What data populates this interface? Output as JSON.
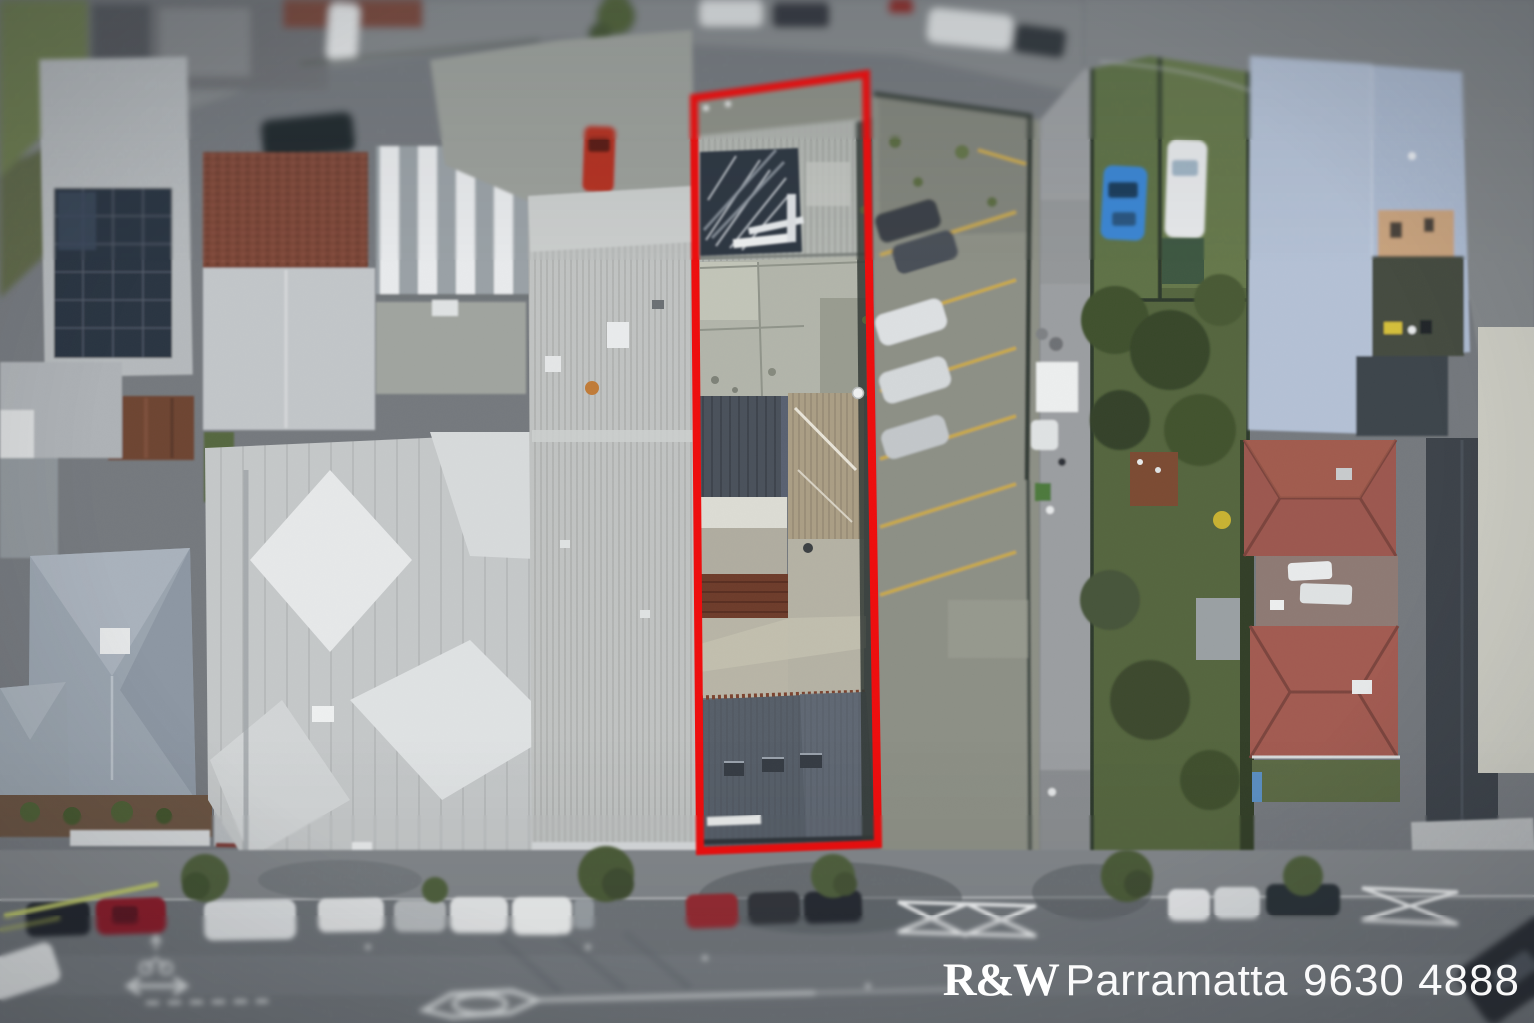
{
  "meta": {
    "canvas_width_px": 1534,
    "canvas_height_px": 1023
  },
  "watermark": {
    "brand": "R&W",
    "office": "Parramatta",
    "phone": "9630 4888",
    "text_color": "#ffffff"
  },
  "property_outline": {
    "color": "#ee0d0d",
    "stroke_width_px": 8
  },
  "scene_colors": {
    "road_asphalt": "#75797e",
    "footpath": "#83878b",
    "parking_lot": "#8d9086",
    "parking_bay_lines": "#c9a94a",
    "grass_yards": "#5e7046",
    "large_blue_roof": "#adbbd1",
    "maroon_hip_roofs": "#9c584f",
    "rust_roof_section": "#6e3c2b",
    "solar_panels": "#2b3542",
    "pale_metal_roof": "#c0c3c2",
    "dark_roof_section": "#4a515b",
    "tan_corrugated_roof": "#ab9e85",
    "blue_car": "#3b86d3",
    "red_parked_car": "#8d1f2c"
  }
}
